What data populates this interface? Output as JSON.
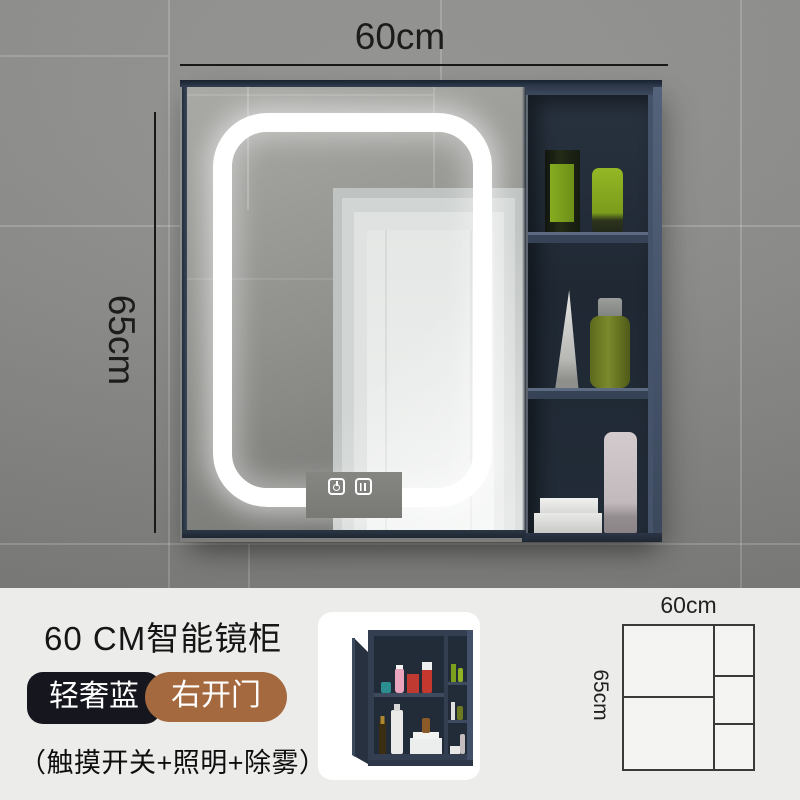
{
  "photo": {
    "width_label": "60cm",
    "height_label": "65cm"
  },
  "product": {
    "title": "60 CM智能镜柜",
    "variant_color": "轻奢蓝",
    "variant_door": "右开门",
    "features": "（触摸开关+照明+除雾）"
  },
  "diagram": {
    "width_label": "60cm",
    "height_label": "65cm"
  },
  "icons": {
    "power": "power-icon",
    "defog": "defog-icon"
  },
  "colors": {
    "wall_gray": "#8d8d8b",
    "cabinet_navy": "#37445a",
    "shelf_interior": "#222c38",
    "led_white": "#ffffff",
    "badge_dark": "#16161e",
    "badge_brown": "#a5693f",
    "info_background": "#ececeb",
    "accent_green_product": "#7b9c1c"
  }
}
